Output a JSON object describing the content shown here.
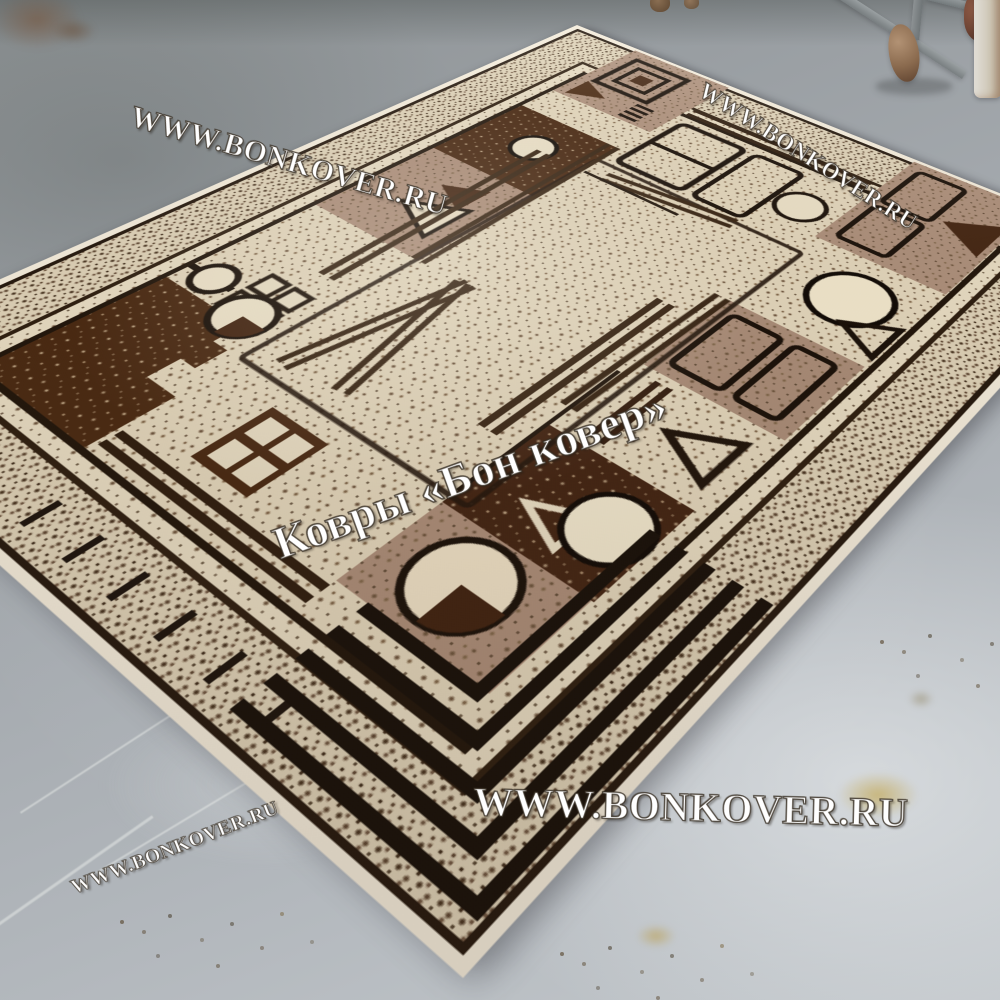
{
  "scene": {
    "subject": "Beige and brown geometric rug lying diagonally on a gray painted concrete floor"
  },
  "watermarks": {
    "top_left": "WWW.BONKOVER.RU",
    "top_right": "WWW.BONKOVER.RU",
    "center": "Ковры «Бон ковер»",
    "bottom_center": "WWW.BONKOVER.RU",
    "bottom_left": "WWW.BONKOVER.RU"
  },
  "colors": {
    "floor_gray": "#a6abb0",
    "rug_field_cream": "#e0d4ba",
    "rug_dark_brown": "#44240e",
    "rug_mocha": "#a98b77",
    "rug_outline_black": "#1d1208",
    "rug_fringe_white": "#f2ebdb",
    "watermark_white": "#ffffff"
  }
}
